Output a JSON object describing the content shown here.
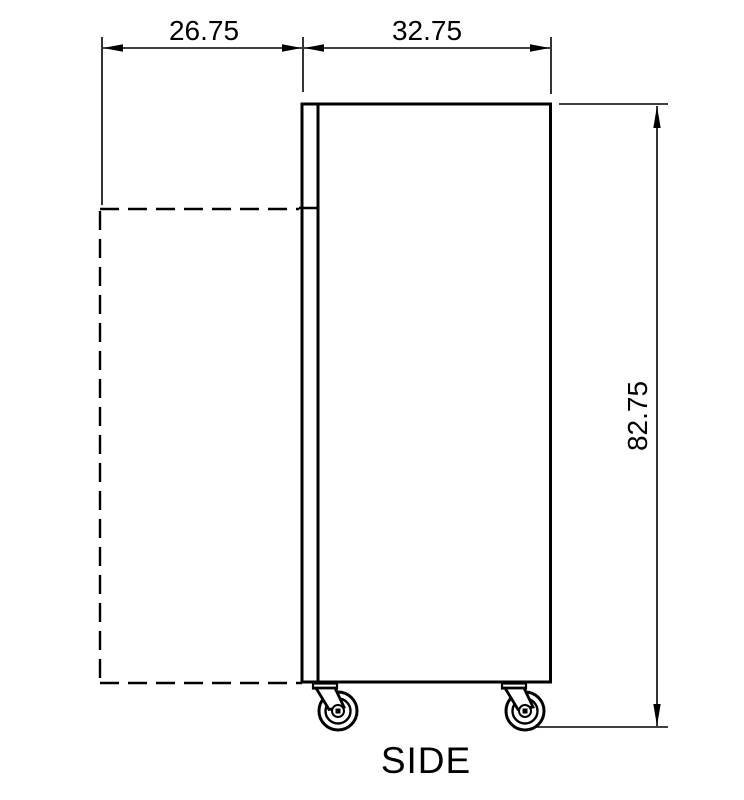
{
  "page": {
    "background_color": "#ffffff",
    "line_color": "#000000"
  },
  "drawing": {
    "view_label": "SIDE",
    "type": "technical-side-elevation",
    "dimensions": {
      "door_swing_depth": {
        "value": "26.75",
        "orientation": "horizontal"
      },
      "cabinet_depth": {
        "value": "32.75",
        "orientation": "horizontal"
      },
      "overall_height": {
        "value": "82.75",
        "orientation": "vertical"
      }
    }
  }
}
